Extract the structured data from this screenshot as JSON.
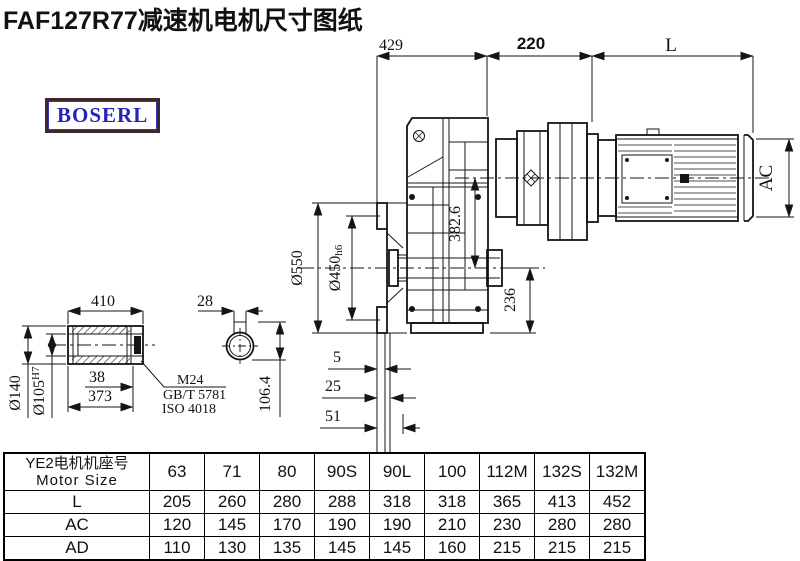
{
  "title": "FAF127R77减速机电机尺寸图纸",
  "logo": "BOSERL",
  "drawing": {
    "top": {
      "seg1": "429",
      "seg2": "220",
      "seg3": "L"
    },
    "main": {
      "flange_od": "Ø550",
      "spigot": "Ø450",
      "spigot_tol": "h6",
      "axis_dist": "382.6",
      "axis_to_bottom": "236",
      "motor_od": "AC",
      "off1": "5",
      "off2": "25",
      "off3": "51"
    },
    "shaft": {
      "len": "410",
      "od": "Ø140",
      "bore": "Ø105",
      "bore_tol": "H7",
      "d38": "38",
      "d373": "373",
      "m24": "M24",
      "gb": "GB/T 5781",
      "iso": "ISO 4018",
      "key_w": "28",
      "key_h": "106.4"
    }
  },
  "table": {
    "header_cn": "YE2电机机座号",
    "header_en": "Motor Size",
    "columns": [
      "63",
      "71",
      "80",
      "90S",
      "90L",
      "100",
      "112M",
      "132S",
      "132M"
    ],
    "rows": [
      {
        "label": "L",
        "values": [
          "205",
          "260",
          "280",
          "288",
          "318",
          "318",
          "365",
          "413",
          "452"
        ]
      },
      {
        "label": "AC",
        "values": [
          "120",
          "145",
          "170",
          "190",
          "190",
          "210",
          "230",
          "280",
          "280"
        ]
      },
      {
        "label": "AD",
        "values": [
          "110",
          "130",
          "135",
          "145",
          "145",
          "160",
          "215",
          "215",
          "215"
        ]
      }
    ]
  }
}
